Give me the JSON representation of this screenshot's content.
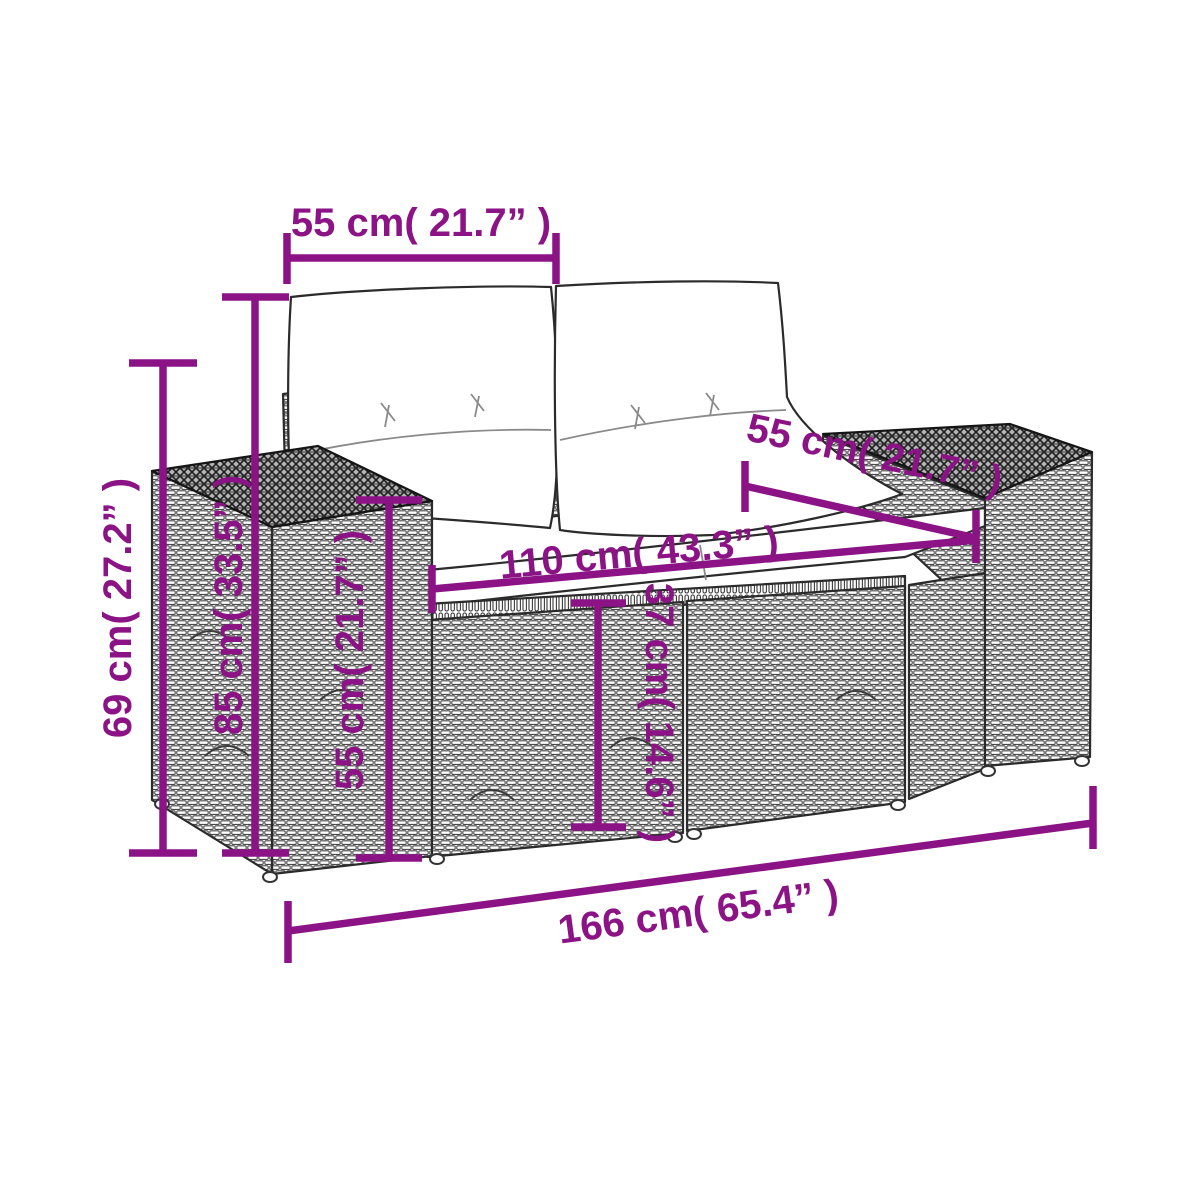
{
  "colors": {
    "dimension": "#8B1385",
    "line_art": "#2B2B2B",
    "cushion": "#FFFFFF",
    "background": "#FFFFFF"
  },
  "diagram": {
    "product": "poly-rattan-garden-bench-with-cushions",
    "view": "perspective-line-art-with-dimensions",
    "dimensions": {
      "cushion_width_top": {
        "label": "55 cm( 21.7” )",
        "value_cm": 55,
        "value_in": 21.7
      },
      "seat_depth": {
        "label": "55 cm( 21.7” )",
        "value_cm": 55,
        "value_in": 21.7
      },
      "seat_width": {
        "label": "110 cm( 43.3” )",
        "value_cm": 110,
        "value_in": 43.3
      },
      "side_height": {
        "label": "69 cm( 27.2” )",
        "value_cm": 69,
        "value_in": 27.2
      },
      "total_height": {
        "label": "85 cm( 33.5” )",
        "value_cm": 85,
        "value_in": 33.5
      },
      "armrest_height": {
        "label": "55 cm( 21.7” )",
        "value_cm": 55,
        "value_in": 21.7
      },
      "seat_height": {
        "label": "37 cm( 14.6” )",
        "value_cm": 37,
        "value_in": 14.6
      },
      "total_width": {
        "label": "166 cm( 65.4” )",
        "value_cm": 166,
        "value_in": 65.4
      }
    }
  }
}
